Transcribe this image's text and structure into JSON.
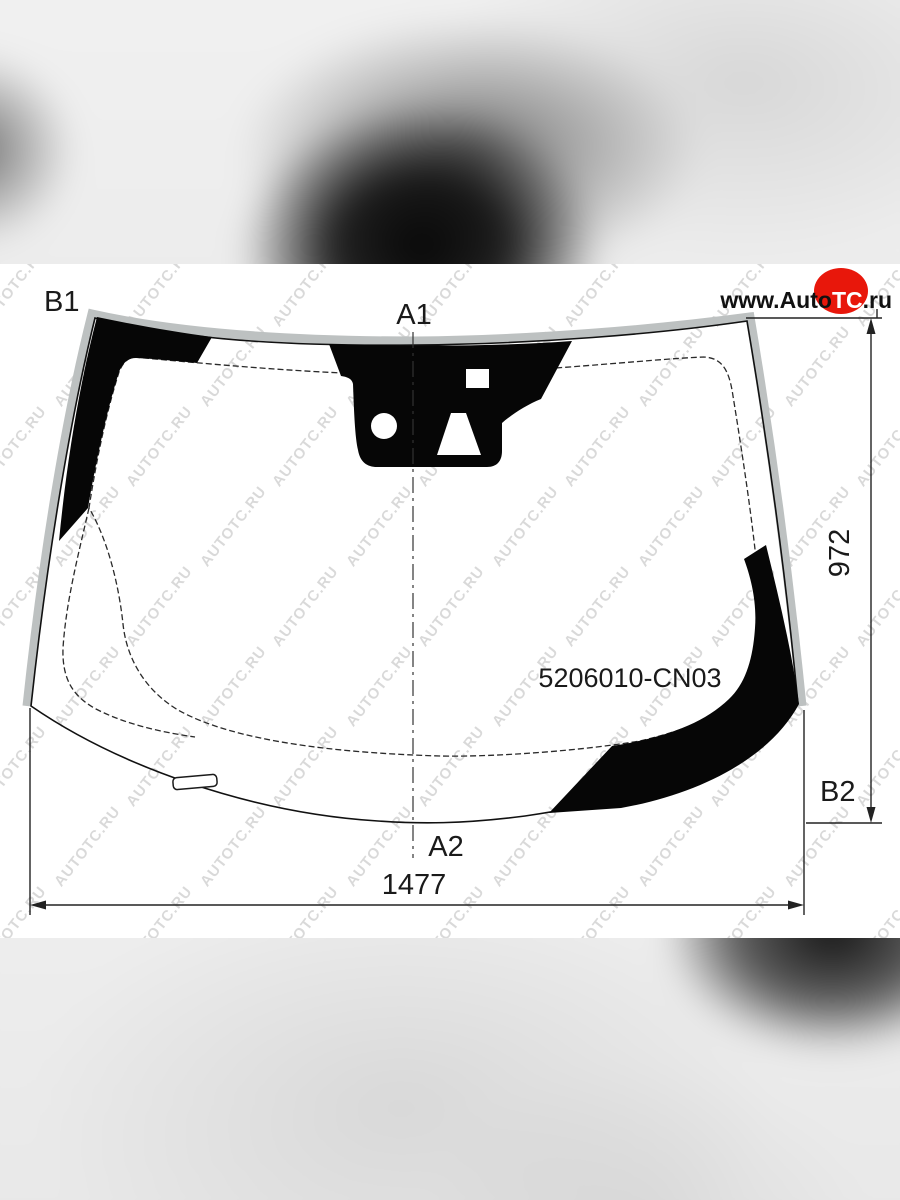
{
  "logo": {
    "prefix": "www.Auto",
    "highlight": "TC",
    "suffix": ".ru",
    "circle_color": "#e8170b",
    "highlight_color": "#ffffff"
  },
  "diagram": {
    "part_number": "5206010-CN03",
    "markers": {
      "top_center": "A1",
      "bottom_center": "A2",
      "top_left": "B1",
      "bottom_right": "B2"
    },
    "dimensions": {
      "width": "1477",
      "height": "972"
    },
    "colors": {
      "frit_black": "#060606",
      "edge_gray": "#bdc1c1",
      "line": "#1a1a1a"
    }
  },
  "watermark": {
    "text": "AUTOTC.RU",
    "color": "rgba(0,0,0,0.15)"
  }
}
